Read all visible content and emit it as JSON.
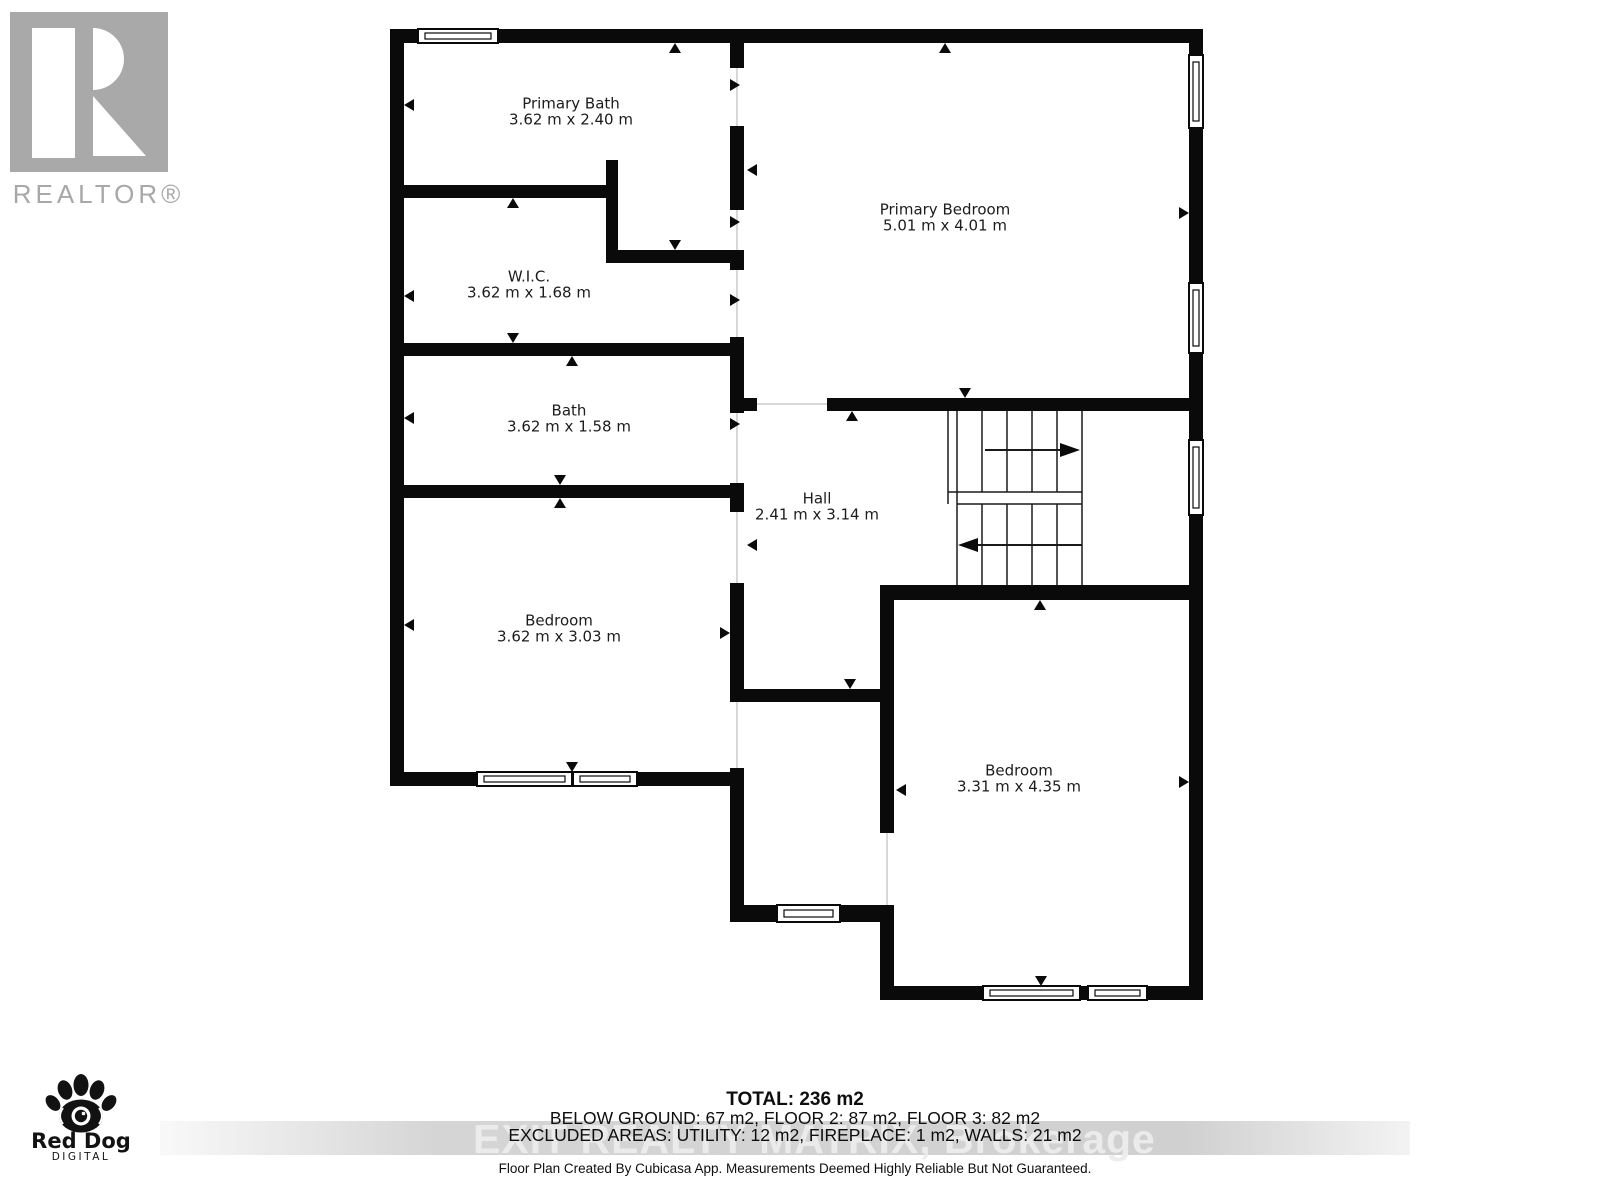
{
  "branding": {
    "realtor_logo_text": "REALTOR®",
    "red_dog": {
      "name": "Red Dog",
      "tagline": "DIGITAL"
    }
  },
  "floor_plan": {
    "rooms": [
      {
        "name": "Primary Bath",
        "dims": "3.62 m x 2.40 m"
      },
      {
        "name": "W.I.C.",
        "dims": "3.62 m x 1.68 m"
      },
      {
        "name": "Bath",
        "dims": "3.62 m x 1.58 m"
      },
      {
        "name": "Bedroom",
        "dims": "3.62 m x 3.03 m"
      },
      {
        "name": "Primary Bedroom",
        "dims": "5.01 m x 4.01 m"
      },
      {
        "name": "Hall",
        "dims": "2.41 m x 3.14 m"
      },
      {
        "name": "Bedroom",
        "dims": "3.31 m x 4.35 m"
      }
    ]
  },
  "summary": {
    "total": "TOTAL: 236 m2",
    "floors": "BELOW GROUND: 67 m2, FLOOR 2: 87 m2, FLOOR 3: 82 m2",
    "excluded": "EXCLUDED AREAS: UTILITY: 12 m2, FIREPLACE: 1 m2, WALLS: 21 m2",
    "disclaimer": "Floor Plan Created By Cubicasa App. Measurements Deemed Highly Reliable But Not Guaranteed."
  },
  "watermark": "EXIT REALTY MATRIX, Brokerage",
  "colors": {
    "wall": "#0a0a0a",
    "logo_gray": "#a9a9a9",
    "watermark_band": "#c5c5c5"
  }
}
